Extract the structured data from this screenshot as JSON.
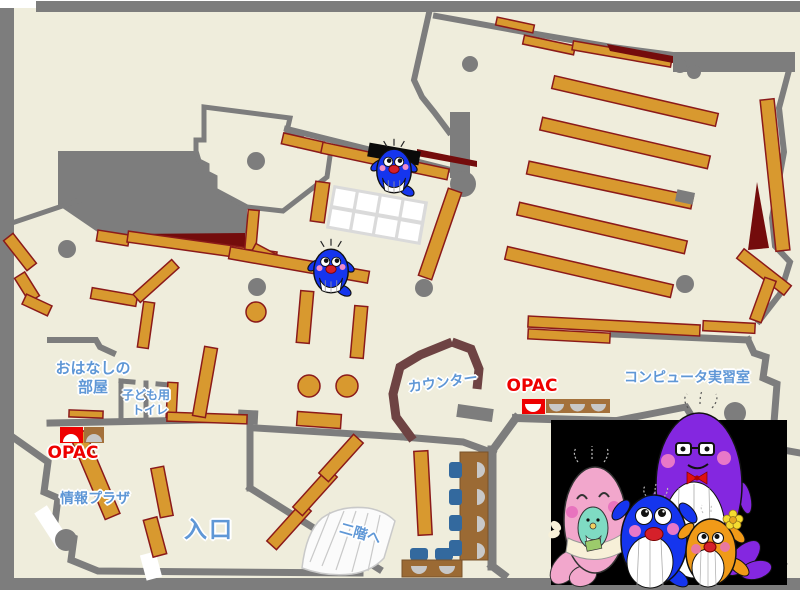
{
  "map": {
    "title": "library-first-floor-map",
    "labels": {
      "storytelling_room_line1": "おはなしの",
      "storytelling_room_line2": "部屋",
      "kids_toilet_line1": "子ども用",
      "kids_toilet_line2": "トイレ",
      "opac_left": "OPAC",
      "info_plaza": "情報プラザ",
      "entrance": "入口",
      "counter": "カウンター",
      "opac_center": "OPAC",
      "computer_room": "コンピュータ実習室",
      "to_second_floor": "二階へ"
    },
    "colors": {
      "floor": "#efeddc",
      "wall_gray": "#7d7d7d",
      "shelf_orange": "#d8992f",
      "shelf_outline": "#8b1a1a",
      "counter_brown": "#6e4343",
      "accent_maroon": "#740c0c",
      "chair_blue": "#33699e",
      "table_brown": "#9b6a34",
      "seat_silver": "#c8c8c8",
      "label_blue": "#5f97d6",
      "label_red": "#ee0000"
    },
    "mascots": {
      "on_map": [
        "blue-whale-mascot",
        "blue-whale-mascot"
      ],
      "photo_panel": [
        "pink-whale-mascot",
        "baby-mint-whale-mascot",
        "blue-whale-mascot",
        "purple-whale-mascot",
        "orange-whale-mascot"
      ]
    }
  }
}
